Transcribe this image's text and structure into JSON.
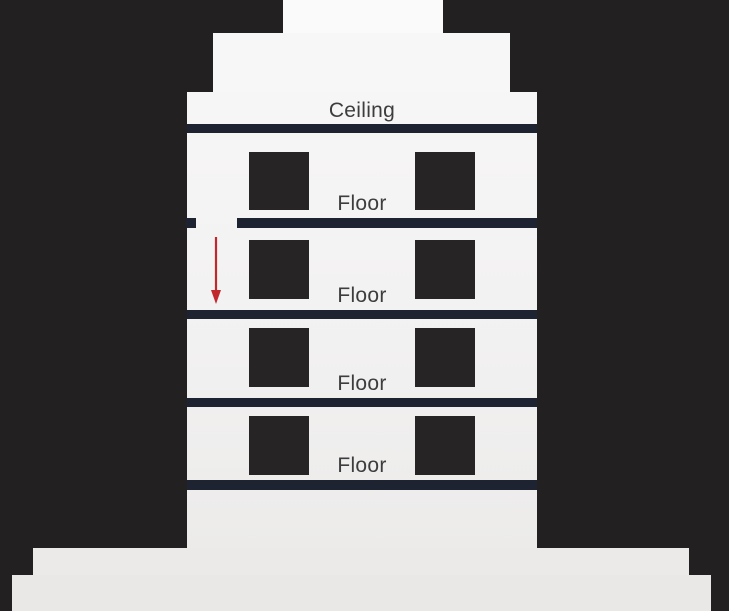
{
  "diagram": {
    "description": "Cross-section of a multi-storey building with labeled ceiling and floor slabs, windows, a gap in the top floor slab, and a red arrow indicating a fall downward through the opening",
    "ceiling_label": "Ceiling",
    "floor_labels": [
      "Floor",
      "Floor",
      "Floor",
      "Floor"
    ],
    "arrow": {
      "direction": "down",
      "color": "#c1272d"
    },
    "colors": {
      "background": "#232021",
      "building_fill": "#f5f4f4",
      "base_fill": "#eae9e8",
      "slab_fill": "#1d2330",
      "window_fill": "#272425",
      "label_text": "#3d3d3d"
    }
  }
}
